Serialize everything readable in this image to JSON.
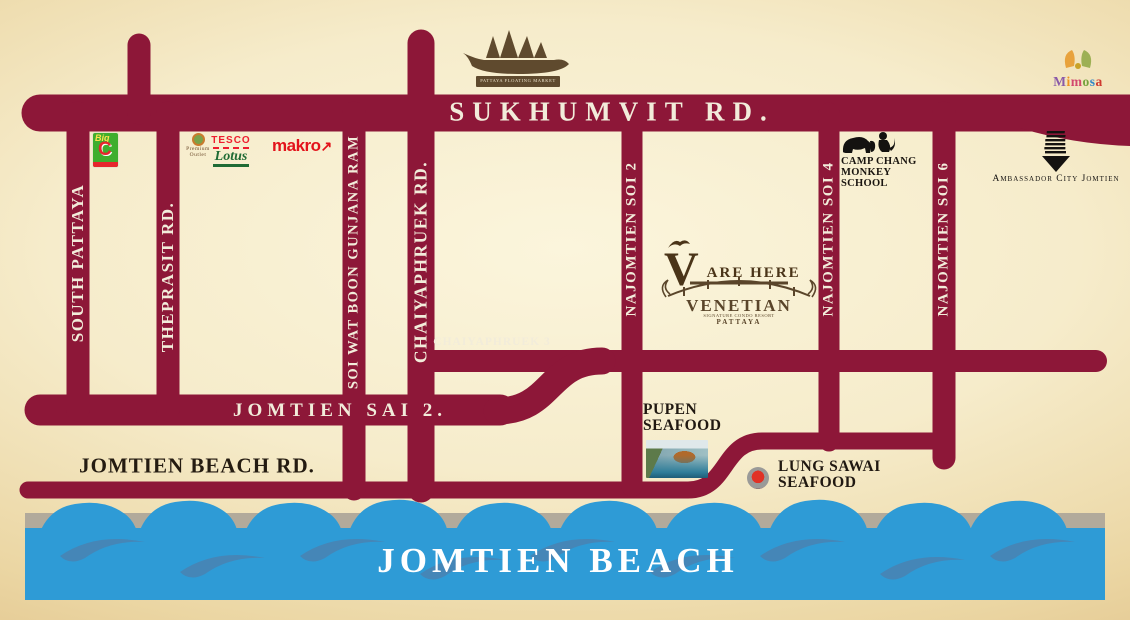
{
  "colors": {
    "road": "#8D1738",
    "road_text": "#F2ECDA",
    "water": "#2E9BD6",
    "water_swirl": "#4884B4",
    "sand": "#B2AA9B",
    "background_edge": "#D9B478",
    "background_center": "#FBF5DC",
    "bigc_green": "#3FAE2E",
    "makro_red": "#E3131B",
    "tesco_red": "#EE1C2E",
    "lotus_green": "#1F6B35",
    "logo_brown": "#5a452a",
    "marker_red": "#e03226"
  },
  "roads": {
    "sukhumvit": "SUKHUMVIT RD.",
    "south_pattaya": "SOUTH PATTAYA",
    "theprasit": "THEPRASIT RD.",
    "soi_wat_boon": "SOI WAT BOON GUNJANA RAM",
    "chaiyaphruek": "CHAIYAPHRUEK RD.",
    "chaiyaphruek3": "CHAIYAPHRUEK 3",
    "najomtien_soi2": "NAJOMTIEN SOI 2",
    "najomtien_soi4": "NAJOMTIEN SOI 4",
    "najomtien_soi6": "NAJOMTIEN SOI 6",
    "jomtien_sai2": "JOMTIEN SAI 2.",
    "jomtien_beach_rd": "JOMTIEN BEACH RD."
  },
  "beach": {
    "label": "JOMTIEN BEACH"
  },
  "landmarks": {
    "big_c": {
      "big": "Big",
      "c": "C"
    },
    "premium_outlet": {
      "line1": "Premium",
      "line2": "Outlet"
    },
    "tesco_lotus": {
      "tesco": "TESCO",
      "lotus": "Lotus"
    },
    "makro": {
      "text": "makro",
      "arrow": "↗"
    },
    "floating_market": {
      "caption": "PATTAYA FLOATING MARKET"
    },
    "mimosa": {
      "letters": [
        "M",
        "i",
        "m",
        "o",
        "s",
        "a"
      ],
      "letter_colors": [
        "#8a5aa8",
        "#f0941f",
        "#d2486e",
        "#76a23e",
        "#2e86c8",
        "#cf3a30"
      ]
    },
    "camp_chang": {
      "line1": "CAMP CHANG",
      "line2": "MONKEY",
      "line3": "SCHOOL"
    },
    "ambassador": {
      "label": "Ambassador City Jomtien"
    },
    "venetian": {
      "v": "V",
      "are_here": "ARE HERE",
      "name": "VENETIAN",
      "sub": "SIGNATURE CONDO RESORT",
      "city": "PATTAYA"
    },
    "pupen": {
      "line1": "PUPEN",
      "line2": "SEAFOOD"
    },
    "lung_sawai": {
      "line1": "LUNG SAWAI",
      "line2": "SEAFOOD"
    }
  }
}
